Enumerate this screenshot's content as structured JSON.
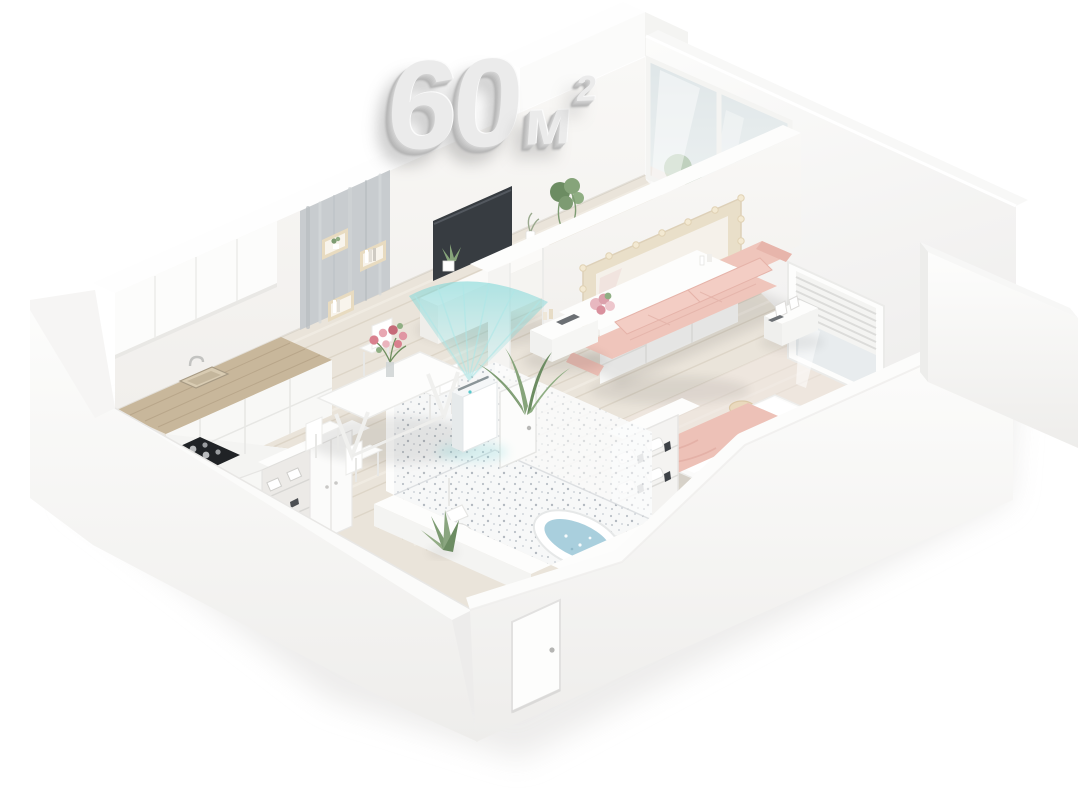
{
  "title": {
    "value": "60",
    "unit": "м",
    "superscript": "2",
    "label": "60 м²"
  },
  "palette": {
    "background": "#ffffff",
    "wall_white": "#fbfbfa",
    "wall_shadow": "#efeeec",
    "floor_wood": "#eae4da",
    "floor_plank_line": "#d9d1c2",
    "counter_wood": "#c8b79b",
    "concrete_panel": "#c8cccf",
    "tv_screen": "#373c41",
    "sofa_pink": "#f0c7bd",
    "blanket_pink": "#edc1b7",
    "purifier_beam_teal": "#7ed7d8",
    "bath_water_blue": "#a9cfdd",
    "mirror_frame_beige": "#e9dfc9",
    "plant_green": "#7d9b72",
    "flower_pink": "#d9808e"
  },
  "scene": {
    "type": "isometric-floor-plan",
    "elements": [
      "kitchen",
      "dining-area",
      "living-room",
      "bedroom",
      "bathroom",
      "balcony-glass-door",
      "bedroom-window",
      "entry-door",
      "air-purifier",
      "sofa",
      "tv",
      "bed",
      "bathtub",
      "wardrobe"
    ]
  }
}
